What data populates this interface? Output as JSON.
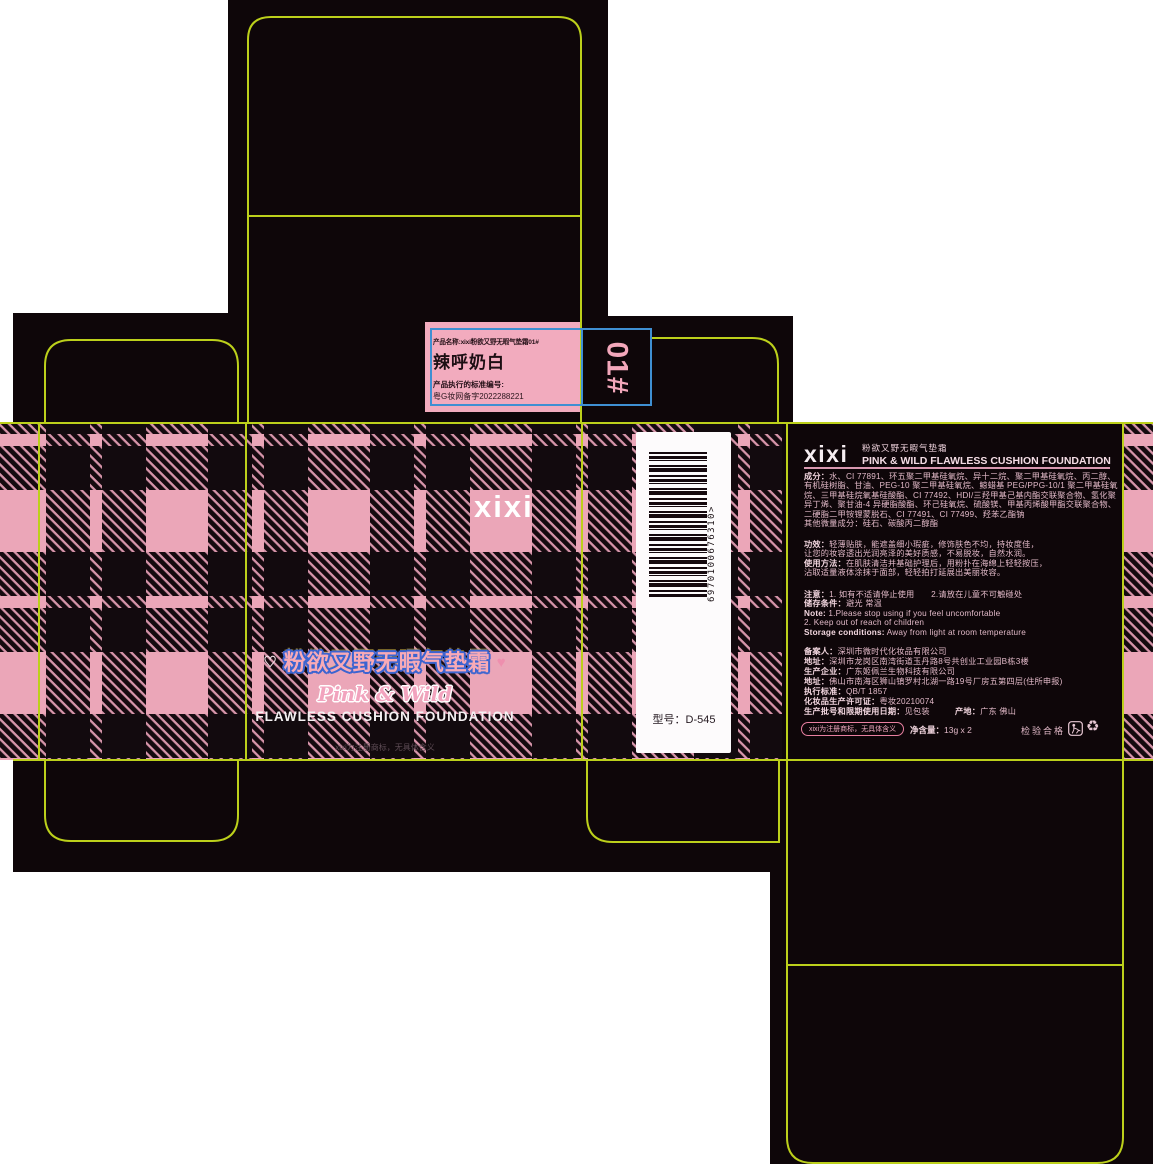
{
  "artwork": {
    "type": "cosmetic packaging dieline",
    "colors": {
      "plaid_pink": "#eba6b8",
      "ink_black": "#140a0f",
      "dieline_yellow": "#bcd01b",
      "guide_blue": "#3f8fd2",
      "label_pink": "#f2abbe",
      "accent_pink": "#f3a7bb",
      "title_outline_blue": "#3c64d0"
    }
  },
  "top_label": {
    "product_name_line": "产品名称:xixi粉欲又野无暇气垫霜01#",
    "shade_name": "辣呼奶白",
    "standard_label": "产品执行的标准编号:",
    "standard_number": "粤G妆网备字2022288221",
    "shade_code": "01#"
  },
  "front_panel": {
    "heart_left": "♡",
    "heart_right": "♥",
    "title_cn": "粉欲又野无暇气垫霜",
    "title_script": "Pink & Wild",
    "title_en": "FLAWLESS CUSHION FOUNDATION",
    "trademark_note": "xixi为注册商标，无具体含义"
  },
  "side_panel": {
    "logo": "xixi",
    "barcode_number": "6970100676310>",
    "model_line": "型号：D-545"
  },
  "back_panel": {
    "logo": "xixi",
    "subtitle_cn": "粉欲又野无暇气垫霜",
    "subtitle_en": "PINK & WILD FLAWLESS CUSHION FOUNDATION",
    "ingredients": [
      "**成分：**水、CI 77891、环五聚二甲基硅氧烷、异十二烷、聚二甲基硅氧烷、丙二醇、",
      "有机硅树脂、甘油、PEG-10 聚二甲基硅氧烷、鲸蜡基 PEG/PPG-10/1 聚二甲基硅氧",
      "烷、三甲基硅烷氧基硅酸酯、CI 77492、HDI/三羟甲基己基内酯交联聚合物、氢化聚",
      "异丁烯、聚甘油-4 异硬脂酸酯、环己硅氧烷、硫酸镁、甲基丙烯酸甲酯交联聚合物、",
      "二硬脂二甲铵锂蒙脱石、CI 77491、CI 77499、羟苯乙酯钠",
      "其他微量成分：硅石、碳酸丙二醇酯"
    ],
    "efficacy": [
      "**功效：**轻薄贴肤，能遮盖细小瑕疵，修饰肤色不均，持妆度佳，",
      "让您的妆容透出光润亮泽的美好质感，不易脱妆，自然水润。",
      "**使用方法：**在肌肤清洁并基础护理后，用粉扑在海绵上轻轻按压，",
      "沾取适量液体涂抹于面部，轻轻拍打延展出美丽妆容。"
    ],
    "notice": [
      "**注意：**1. 如有不适请停止使用　　2.请放在儿童不可触碰处",
      "**储存条件：**避光 常温",
      "**Note:** 1.Please stop using if you feel uncomfortable",
      "2. Keep out of reach of children",
      "**Storage conditions:** Away from light at room temperature"
    ],
    "registration": [
      "**备案人：**深圳市微时代化妆品有限公司",
      "**地址：**深圳市龙岗区南湾街道玉丹路8号共创业工业园B栋3楼",
      "**生产企业：**广东姬佩兰生物科技有限公司",
      "**地址：**佛山市南海区狮山镇罗村北湖一路19号厂房五第四层(住所申报)",
      "**执行标准：**QB/T 1857",
      "**化妆品生产许可证：**粤妆20210074",
      "**生产批号和限期使用日期：**见包装　　　**产地：**广东 佛山"
    ],
    "trademark_pill": "xixi为注册商标，无具体含义",
    "net_content": "**净含量：**13g x 2",
    "inspection": "检验合格",
    "recycle_icon": "♻"
  }
}
